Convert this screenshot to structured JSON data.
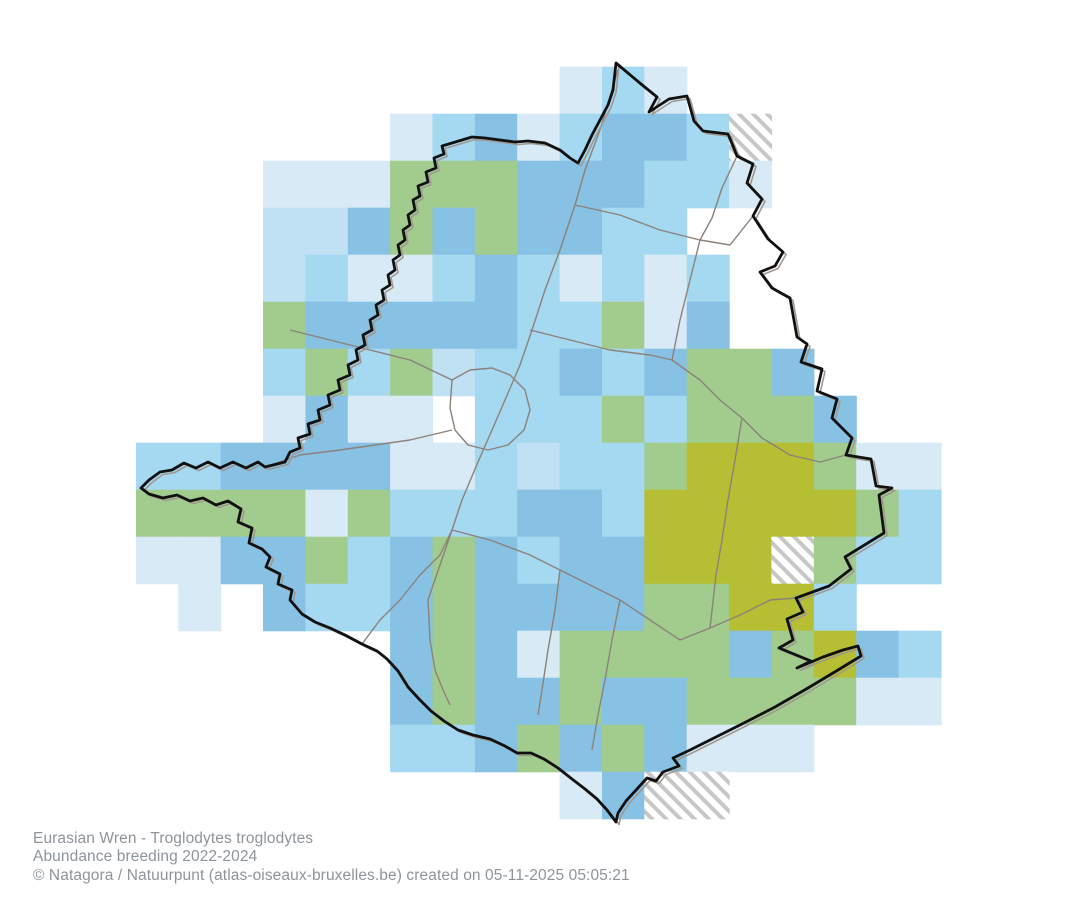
{
  "caption": {
    "species_line": "Eurasian Wren - Troglodytes troglodytes",
    "subject_line": "Abundance breeding 2022-2024",
    "credit_line": "© Natagora / Natuurpunt (atlas-oiseaux-bruxelles.be) created on 05-11-2025 05:05:21"
  },
  "map": {
    "background_color": "#ffffff",
    "region_outline_color": "#111111",
    "region_outline_halo_color": "#a09890",
    "commune_border_color": "#8c827a",
    "hatch_stripe_color": "#c7c7c7"
  },
  "grid": {
    "origin_x": 135.9,
    "origin_y": 66.7,
    "cell_w": 42.37,
    "cell_h": 47.0,
    "classes": {
      "c1": "#d9eaf7",
      "c2": "#c0e0f4",
      "c3": "#a5d8f1",
      "c4": "#87c1e3",
      "c5": "#a1cc8e",
      "c6": "#b6be34"
    },
    "class_meaning": {
      "c1": "abundance-lowest",
      "c2": "abundance-low",
      "c3": "abundance-medium",
      "c4": "abundance-high",
      "c5": "abundance-higher",
      "c6": "abundance-highest",
      "h": "not-surveyed-hatched"
    },
    "cells": [
      [
        10,
        0,
        1
      ],
      [
        11,
        0,
        3
      ],
      [
        12,
        0,
        1
      ],
      [
        6,
        1,
        1
      ],
      [
        7,
        1,
        3
      ],
      [
        8,
        1,
        4
      ],
      [
        9,
        1,
        1
      ],
      [
        10,
        1,
        3
      ],
      [
        11,
        1,
        4
      ],
      [
        12,
        1,
        4
      ],
      [
        13,
        1,
        3
      ],
      [
        14,
        1,
        "h"
      ],
      [
        3,
        2,
        1
      ],
      [
        4,
        2,
        1
      ],
      [
        5,
        2,
        1
      ],
      [
        6,
        2,
        5
      ],
      [
        7,
        2,
        5
      ],
      [
        8,
        2,
        5
      ],
      [
        9,
        2,
        4
      ],
      [
        10,
        2,
        4
      ],
      [
        11,
        2,
        4
      ],
      [
        12,
        2,
        3
      ],
      [
        13,
        2,
        3
      ],
      [
        14,
        2,
        1
      ],
      [
        3,
        3,
        2
      ],
      [
        4,
        3,
        2
      ],
      [
        5,
        3,
        4
      ],
      [
        6,
        3,
        5
      ],
      [
        7,
        3,
        4
      ],
      [
        8,
        3,
        5
      ],
      [
        9,
        3,
        4
      ],
      [
        10,
        3,
        4
      ],
      [
        11,
        3,
        3
      ],
      [
        12,
        3,
        3
      ],
      [
        3,
        4,
        2
      ],
      [
        4,
        4,
        3
      ],
      [
        5,
        4,
        1
      ],
      [
        6,
        4,
        1
      ],
      [
        7,
        4,
        3
      ],
      [
        8,
        4,
        4
      ],
      [
        9,
        4,
        3
      ],
      [
        10,
        4,
        1
      ],
      [
        11,
        4,
        3
      ],
      [
        12,
        4,
        1
      ],
      [
        13,
        4,
        3
      ],
      [
        3,
        5,
        5
      ],
      [
        4,
        5,
        4
      ],
      [
        5,
        5,
        4
      ],
      [
        6,
        5,
        4
      ],
      [
        7,
        5,
        4
      ],
      [
        8,
        5,
        4
      ],
      [
        9,
        5,
        3
      ],
      [
        10,
        5,
        3
      ],
      [
        11,
        5,
        5
      ],
      [
        12,
        5,
        1
      ],
      [
        13,
        5,
        4
      ],
      [
        3,
        6,
        3
      ],
      [
        4,
        6,
        5
      ],
      [
        5,
        6,
        3
      ],
      [
        6,
        6,
        5
      ],
      [
        7,
        6,
        2
      ],
      [
        8,
        6,
        3
      ],
      [
        9,
        6,
        3
      ],
      [
        10,
        6,
        4
      ],
      [
        11,
        6,
        3
      ],
      [
        12,
        6,
        4
      ],
      [
        13,
        6,
        5
      ],
      [
        14,
        6,
        5
      ],
      [
        15,
        6,
        4
      ],
      [
        3,
        7,
        1
      ],
      [
        4,
        7,
        4
      ],
      [
        5,
        7,
        1
      ],
      [
        6,
        7,
        1
      ],
      [
        8,
        7,
        3
      ],
      [
        9,
        7,
        3
      ],
      [
        10,
        7,
        3
      ],
      [
        11,
        7,
        5
      ],
      [
        12,
        7,
        3
      ],
      [
        13,
        7,
        5
      ],
      [
        14,
        7,
        5
      ],
      [
        15,
        7,
        5
      ],
      [
        16,
        7,
        4
      ],
      [
        0,
        8,
        3
      ],
      [
        1,
        8,
        3
      ],
      [
        2,
        8,
        4
      ],
      [
        3,
        8,
        4
      ],
      [
        4,
        8,
        4
      ],
      [
        5,
        8,
        4
      ],
      [
        6,
        8,
        1
      ],
      [
        7,
        8,
        1
      ],
      [
        8,
        8,
        3
      ],
      [
        9,
        8,
        2
      ],
      [
        10,
        8,
        3
      ],
      [
        11,
        8,
        3
      ],
      [
        12,
        8,
        5
      ],
      [
        13,
        8,
        6
      ],
      [
        14,
        8,
        6
      ],
      [
        15,
        8,
        6
      ],
      [
        16,
        8,
        5
      ],
      [
        17,
        8,
        1
      ],
      [
        18,
        8,
        1
      ],
      [
        0,
        9,
        5
      ],
      [
        1,
        9,
        5
      ],
      [
        2,
        9,
        5
      ],
      [
        3,
        9,
        5
      ],
      [
        4,
        9,
        1
      ],
      [
        5,
        9,
        5
      ],
      [
        6,
        9,
        3
      ],
      [
        7,
        9,
        3
      ],
      [
        8,
        9,
        3
      ],
      [
        9,
        9,
        4
      ],
      [
        10,
        9,
        4
      ],
      [
        11,
        9,
        3
      ],
      [
        12,
        9,
        6
      ],
      [
        13,
        9,
        6
      ],
      [
        14,
        9,
        6
      ],
      [
        15,
        9,
        6
      ],
      [
        16,
        9,
        6
      ],
      [
        17,
        9,
        5
      ],
      [
        18,
        9,
        3
      ],
      [
        0,
        10,
        1
      ],
      [
        1,
        10,
        1
      ],
      [
        2,
        10,
        4
      ],
      [
        3,
        10,
        4
      ],
      [
        4,
        10,
        5
      ],
      [
        5,
        10,
        3
      ],
      [
        6,
        10,
        4
      ],
      [
        7,
        10,
        5
      ],
      [
        8,
        10,
        4
      ],
      [
        9,
        10,
        3
      ],
      [
        10,
        10,
        4
      ],
      [
        11,
        10,
        4
      ],
      [
        12,
        10,
        6
      ],
      [
        13,
        10,
        6
      ],
      [
        14,
        10,
        6
      ],
      [
        15,
        10,
        "h"
      ],
      [
        16,
        10,
        5
      ],
      [
        17,
        10,
        3
      ],
      [
        18,
        10,
        3
      ],
      [
        1,
        11,
        1
      ],
      [
        3,
        11,
        4
      ],
      [
        4,
        11,
        3
      ],
      [
        5,
        11,
        3
      ],
      [
        6,
        11,
        4
      ],
      [
        7,
        11,
        5
      ],
      [
        8,
        11,
        4
      ],
      [
        9,
        11,
        4
      ],
      [
        10,
        11,
        4
      ],
      [
        11,
        11,
        4
      ],
      [
        12,
        11,
        5
      ],
      [
        13,
        11,
        5
      ],
      [
        14,
        11,
        6
      ],
      [
        15,
        11,
        6
      ],
      [
        16,
        11,
        3
      ],
      [
        6,
        12,
        4
      ],
      [
        7,
        12,
        5
      ],
      [
        8,
        12,
        4
      ],
      [
        9,
        12,
        1
      ],
      [
        10,
        12,
        5
      ],
      [
        11,
        12,
        5
      ],
      [
        12,
        12,
        5
      ],
      [
        13,
        12,
        5
      ],
      [
        14,
        12,
        4
      ],
      [
        15,
        12,
        5
      ],
      [
        16,
        12,
        6
      ],
      [
        17,
        12,
        4
      ],
      [
        18,
        12,
        3
      ],
      [
        6,
        13,
        4
      ],
      [
        7,
        13,
        5
      ],
      [
        8,
        13,
        4
      ],
      [
        9,
        13,
        4
      ],
      [
        10,
        13,
        5
      ],
      [
        11,
        13,
        4
      ],
      [
        12,
        13,
        4
      ],
      [
        13,
        13,
        5
      ],
      [
        14,
        13,
        5
      ],
      [
        15,
        13,
        5
      ],
      [
        16,
        13,
        5
      ],
      [
        17,
        13,
        1
      ],
      [
        18,
        13,
        1
      ],
      [
        6,
        14,
        3
      ],
      [
        7,
        14,
        3
      ],
      [
        8,
        14,
        4
      ],
      [
        9,
        14,
        5
      ],
      [
        10,
        14,
        4
      ],
      [
        11,
        14,
        5
      ],
      [
        12,
        14,
        4
      ],
      [
        13,
        14,
        1
      ],
      [
        14,
        14,
        1
      ],
      [
        15,
        14,
        1
      ],
      [
        10,
        15,
        1
      ],
      [
        11,
        15,
        4
      ],
      [
        12,
        15,
        "h"
      ],
      [
        13,
        15,
        "h"
      ]
    ]
  },
  "boundary": {
    "region_path": "M616 63 L641 84 L657 97 L649 112 L669 99 L687 96 L694 121 L703 131 L728 134 L737 156 L753 164 L747 183 L762 199 L753 216 L768 239 L783 252 L775 266 L760 272 L772 288 L790 298 L797 337 L807 344 L801 362 L822 369 L817 391 L837 399 L832 418 L852 438 L846 455 L871 459 L876 486 L892 488 L879 495 L884 533 L845 557 L851 569 L829 586 L796 598 L803 612 L787 619 L793 640 L779 648 L811 661 L797 668 L823 657 L843 650 L858 646 L861 656 L838 670 L808 688 L775 707 L742 724 L712 739 L688 751 L673 758 L679 766 L663 772 L656 781 L647 778 L637 789 L626 801 L618 813 L616 822 L607 810 L597 799 L585 789 L572 779 L558 768 L544 759 L531 753 L517 753 L505 746 L490 739 L473 735 L458 730 L444 721 L431 711 L419 699 L408 687 L398 671 L387 659 L377 651 L362 644 L345 635 L330 628 L315 622 L302 614 L290 600 L292 590 L278 584 L280 574 L266 567 L270 557 L262 549 L249 543 L252 528 L238 522 L241 509 L228 501 L216 505 L203 498 L190 501 L177 495 L163 498 L149 494 L141 488 L149 480 L160 472 L172 470 L184 463 L196 468 L208 462 L220 468 L233 462 L246 468 L258 462 L265 467 L285 462 L290 452 L300 448 L298 438 L310 434 L308 424 L320 420 L318 410 L330 405 L328 395 L340 390 L338 380 L350 375 L348 365 L358 360 L356 350 L365 345 L363 335 L372 330 L370 320 L378 315 L376 305 L384 300 L382 290 L390 285 L388 275 L395 270 L393 260 L400 255 L398 245 L405 240 L403 230 L410 225 L408 215 L415 210 L413 200 L420 196 L418 186 L428 182 L426 172 L436 168 L434 158 L444 154 L442 146 L452 143 L462 140 L472 137 L485 138 L500 140 L515 142 L528 141 L545 143 L560 150 L570 158 L578 163 L585 150 L592 135 L600 120 L608 105 L613 90 Z",
    "commune_paths": [
      "M618 70 L600 130 L585 170 L575 205 L560 250 L545 290 L532 330 L520 365 L505 400 L492 430 L478 462 L462 500 L452 530 L440 565 L428 600 L430 640 L435 670 L443 690 L450 705",
      "M452 380 L470 370 L492 368 L510 375 L525 390 L530 410 L524 430 L508 445 L488 450 L468 445 L455 430 L450 408 Z",
      "M265 467 L300 455 L340 450 L375 445 L410 440 L452 430",
      "M575 205 L620 215 L660 230 L700 240 L730 245 L753 216",
      "M700 240 L690 280 L680 320 L672 360",
      "M530 330 L570 340 L610 350 L650 355 L672 360",
      "M672 360 L700 380 L720 400 L742 418 L762 438 L790 455 L820 462 L846 455",
      "M452 530 L490 540 L530 555 L560 570 L590 585 L620 600 L650 620 L680 640 L710 628 L740 615 L770 600 L796 598",
      "M560 570 L555 610 L548 650 L542 690 L538 715",
      "M362 644 L380 620 L400 600 L420 575 L440 555 L452 530",
      "M737 156 L722 188 L712 218 L700 240",
      "M620 600 L612 640 L605 680 L598 715 L592 750",
      "M290 330 L330 340 L370 350 L410 360 L452 380",
      "M742 418 L735 460 L728 500 L722 540 L716 575 L710 628"
    ]
  }
}
